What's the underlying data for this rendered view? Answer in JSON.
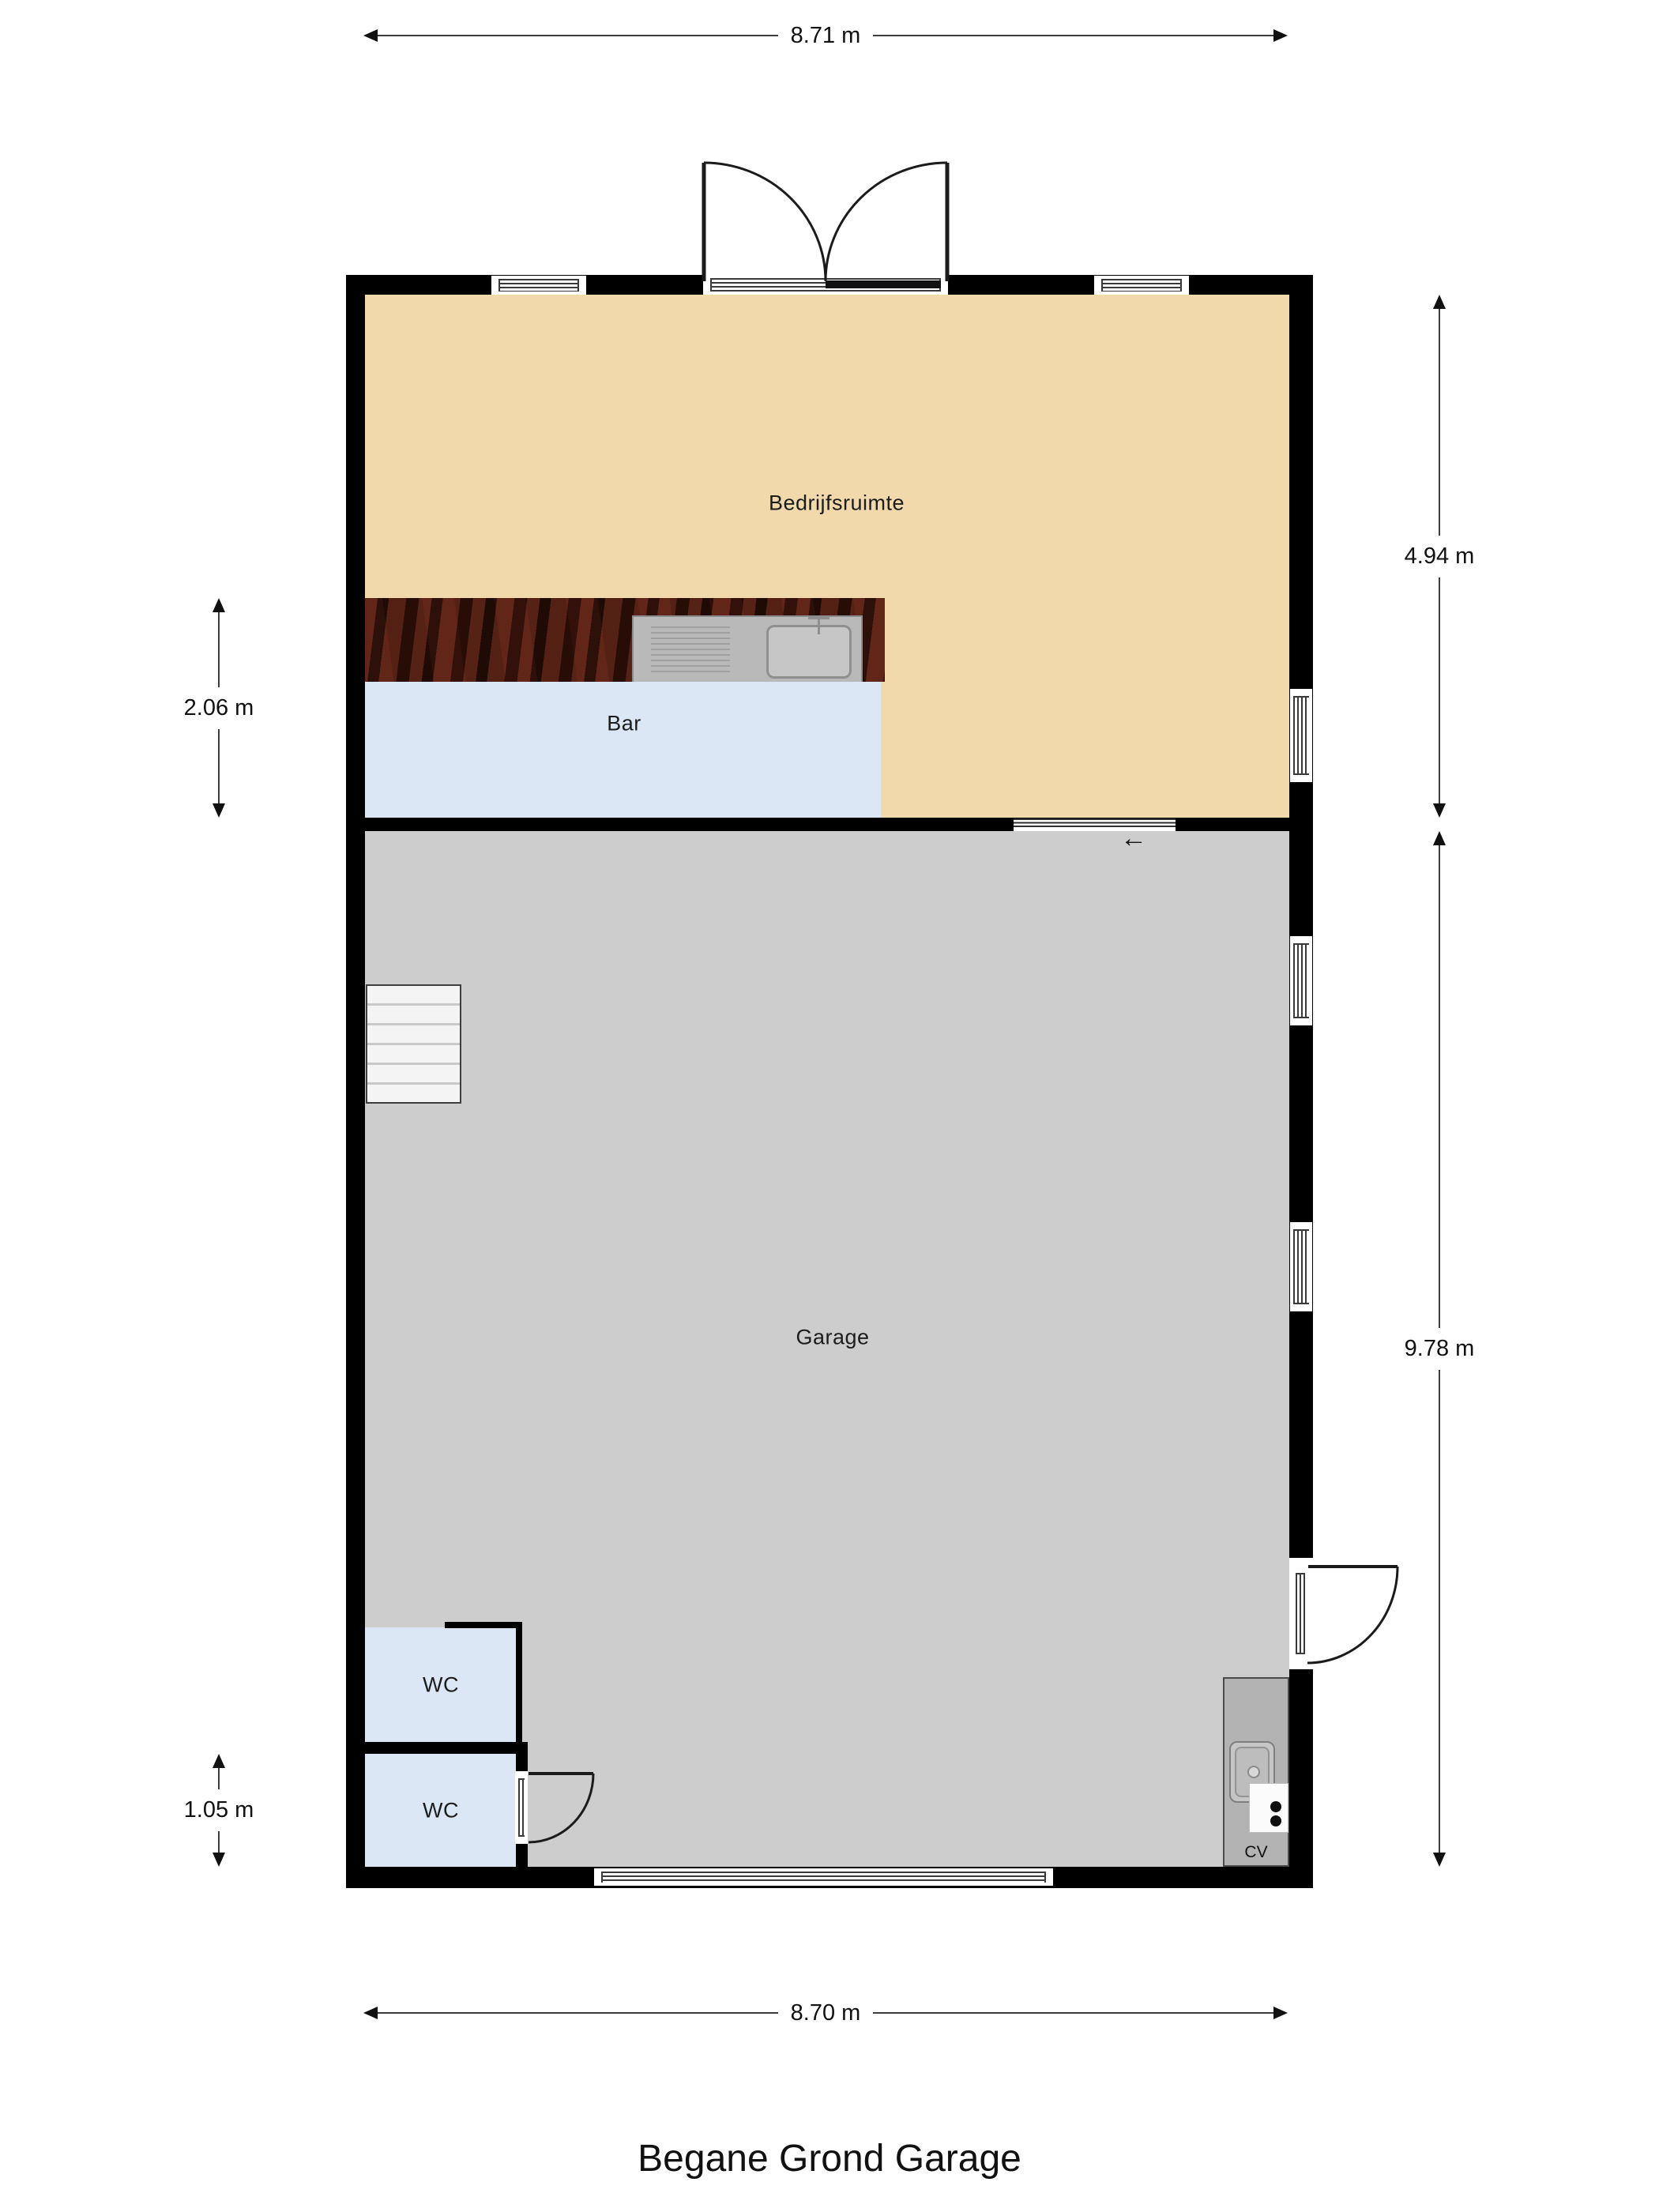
{
  "title": "Begane Grond Garage",
  "rooms": {
    "bedrijfsruimte": {
      "label": "Bedrijfsruimte"
    },
    "bar": {
      "label": "Bar"
    },
    "garage": {
      "label": "Garage"
    },
    "wc_upper": {
      "label": "WC"
    },
    "wc_lower": {
      "label": "WC"
    },
    "cv": {
      "label": "CV"
    }
  },
  "dimensions": {
    "top_width": "8.71 m",
    "bottom_width": "8.70 m",
    "right_upper_height": "4.94 m",
    "right_lower_height": "9.78 m",
    "left_bar_height": "2.06 m",
    "left_wc_height": "1.05 m"
  },
  "icons": {
    "sliding_door_arrow": "←"
  },
  "colors": {
    "wall": "#000000",
    "bedrijfsruimte_floor": "#f2d9ab",
    "bar_floor": "#dbe7f5",
    "wc_floor": "#dbe7f5",
    "garage_floor": "#cdcdcd",
    "cv_floor": "#b3b3b3",
    "counter_wood": "#40150c",
    "dimension_text": "#111111"
  }
}
